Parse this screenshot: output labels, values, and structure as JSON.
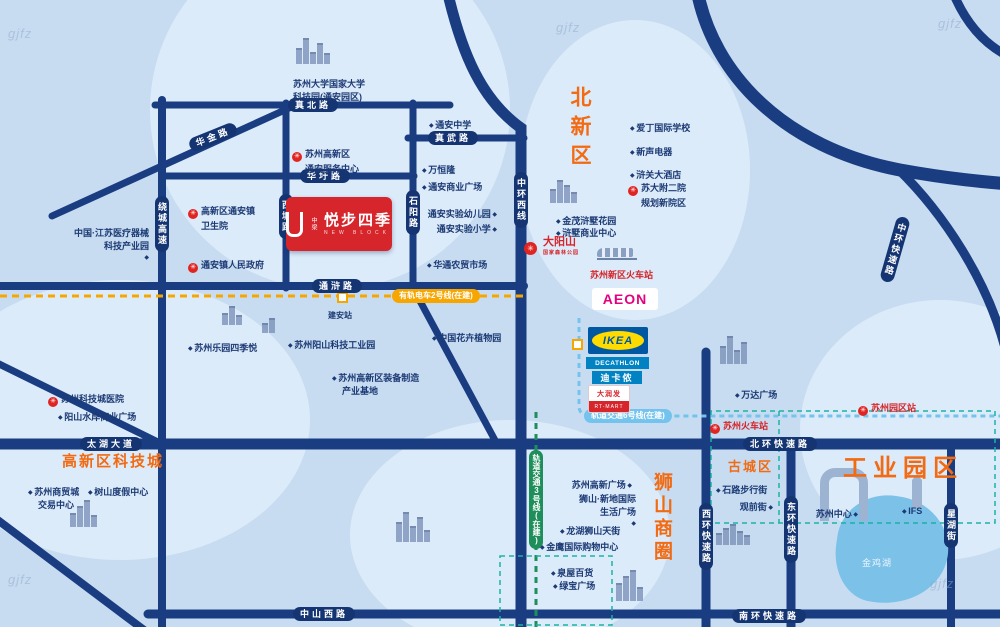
{
  "watermark": "gjfz",
  "project": {
    "brand": "中梁",
    "name": "悦步四季",
    "sub": "NEW BLOCK"
  },
  "districts": {
    "beixinqu": "北新区",
    "kejicheng": "高新区科技城",
    "shishan": "狮山商圈",
    "gucheng": "古城区",
    "yuanqu": "工业园区"
  },
  "roads": {
    "zhenbei": "真北路",
    "huajin": "华金路",
    "zhenwu": "真武路",
    "huawei": "华圩路",
    "tonghu": "通浒路",
    "taihu": "太湖大道",
    "beihuan": "北环快速路",
    "zhongshanxi": "中山西路",
    "nanhuan": "南环快速路",
    "raocheng": "绕城高速",
    "xitang": "西塘路",
    "shiyang": "石阳路",
    "zhonghuanxi": "中环西线",
    "zhonghuan": "中环快速路",
    "xihuan": "西环快速路",
    "donghuan": "东环快速路",
    "xinghu": "星湖街"
  },
  "transit": {
    "tram2": "有轨电车2号线(在建)",
    "metro3": "轨道交通3号线(在建)",
    "metro6": "轨道交通6号线(在建)",
    "jianan": "建安站"
  },
  "stations": {
    "xinqu": "苏州新区火车站",
    "suzhou": "苏州火车站",
    "yuanquzhan": "苏州园区站"
  },
  "logos": {
    "aeon": "AEON",
    "ikea": "IKEA",
    "decathlon": "DECATHLON",
    "dikalong": "迪卡侬",
    "rt_cn": "大润发",
    "rt_en": "RT-MART",
    "dys": "大阳山",
    "dys_sub": "国家森林公园"
  },
  "lake": "金鸡湖",
  "pois": {
    "univ1": "苏州大学国家大学",
    "univ2": "科技园(通安园区)",
    "ta_center1": "苏州高新区",
    "ta_center2": "通安服务中心",
    "ta_wsy1": "高新区通安镇",
    "ta_wsy2": "卫生院",
    "ta_gov": "通安镇人民政府",
    "med1": "中国·江苏医疗器械",
    "med2": "科技产业园",
    "ta_zhongxue": "通安中学",
    "wanhenglong": "万恒隆",
    "ta_shangye": "通安商业广场",
    "ta_youer": "通安实验幼儿园",
    "ta_xiaoxue": "通安实验小学",
    "huatong": "华通农贸市场",
    "leyuan": "苏州乐园四季悦",
    "yangshan": "苏州阳山科技工业园",
    "zhuangbei1": "苏州高新区装备制造",
    "zhuangbei2": "产业基地",
    "huahui": "中国花卉植物园",
    "jinmao": "金茂浒墅花园",
    "hsshangye": "浒墅商业中心",
    "aiding": "爱丁国际学校",
    "xinsheng": "新声电器",
    "hsjiudian": "浒关大酒店",
    "suda1": "苏大附二院",
    "suda2": "规划新院区",
    "kjc_hosp": "苏州科技城医院",
    "shuian": "阳山水岸商业广场",
    "smc1": "苏州商贸城",
    "smc2": "交易中心",
    "shushan": "树山度假中心",
    "wanda": "万达广场",
    "shilu": "石路步行街",
    "guanqian": "观前街",
    "szzx": "苏州中心",
    "ifs": "IFS",
    "gaoxin_gc": "苏州高新广场",
    "xindi1": "狮山·新地国际",
    "xindi2": "生活广场",
    "longhu": "龙湖狮山天街",
    "jinying": "金鹰国际购物中心",
    "quanwu": "泉屋百货",
    "lvbao": "绿宝广场"
  }
}
